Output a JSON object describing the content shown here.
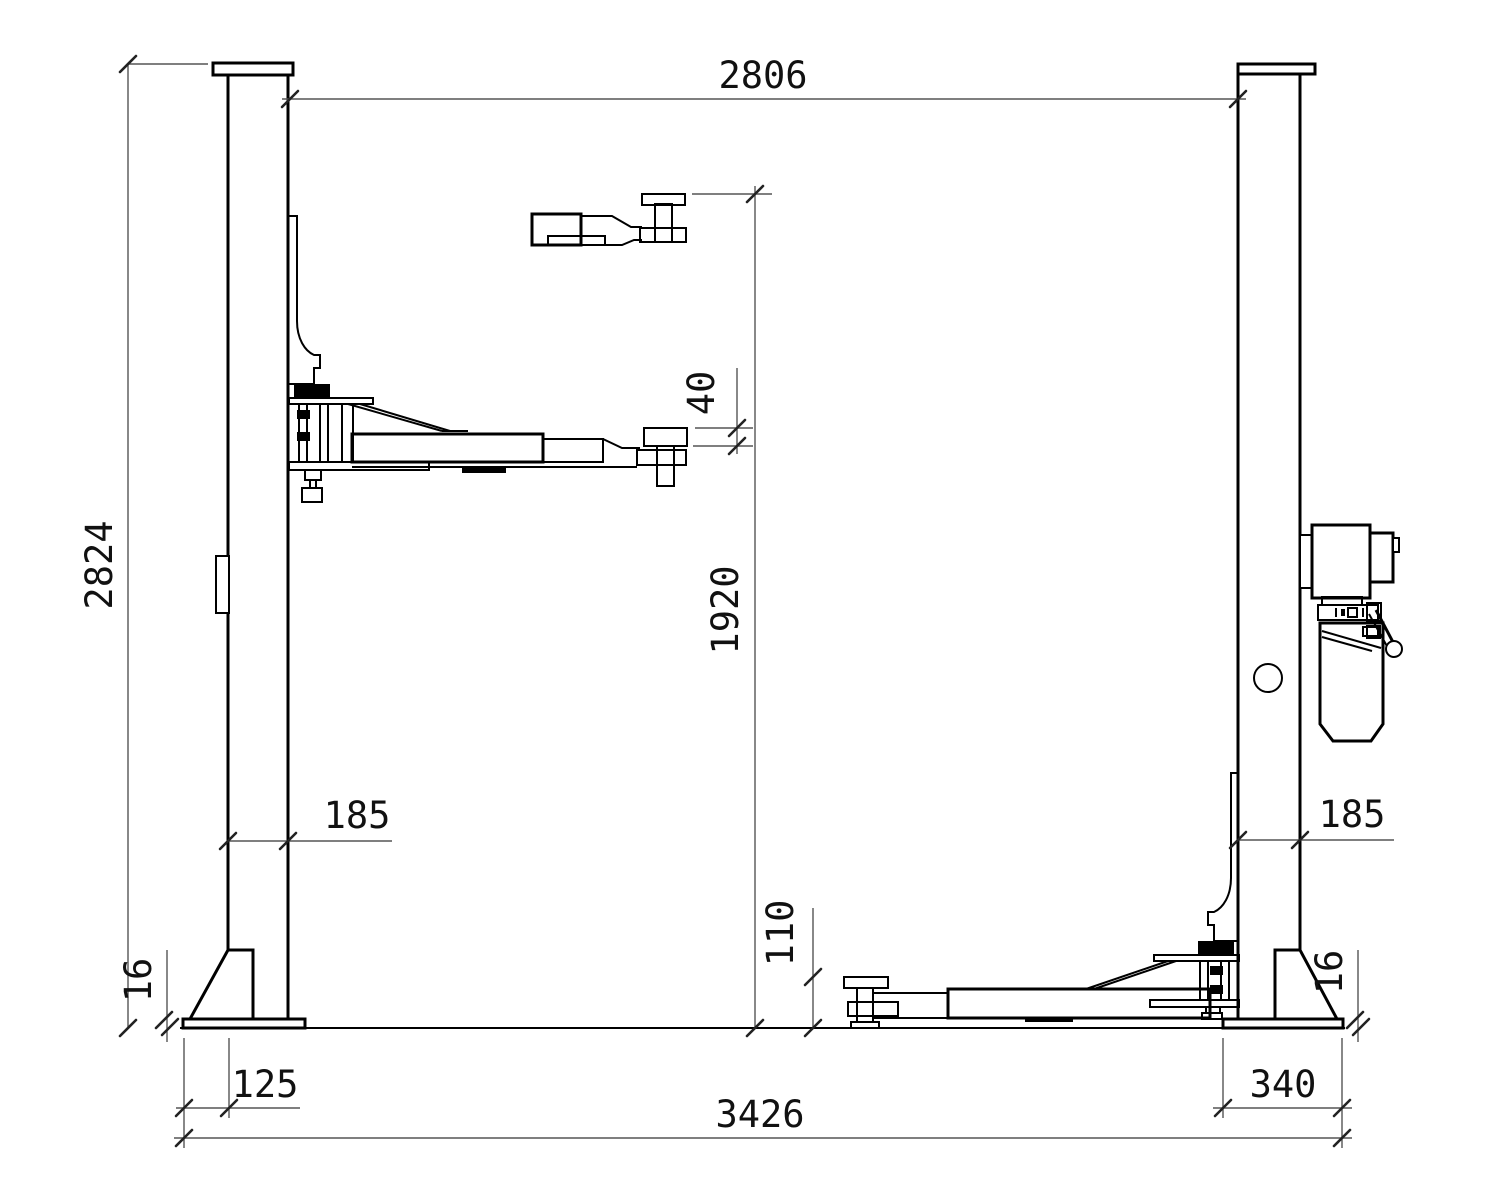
{
  "drawing": {
    "title": "Two-post vehicle lift - dimensional front view",
    "units": "mm",
    "background": "#ffffff",
    "outline_color": "#000000",
    "dimension_line_color": "#555555",
    "text_color": "#111111",
    "dimensions": {
      "overall_height": "2824",
      "between_posts": "2806",
      "max_lift_height": "1920",
      "pad_screw_travel": "40",
      "left_post_width": "185",
      "right_post_width": "185",
      "min_pad_height": "110",
      "left_plate_thickness": "16",
      "right_plate_thickness": "16",
      "left_plate_overhang": "125",
      "right_plate_overhang": "340",
      "overall_width": "3426"
    },
    "parts": {
      "left_post": "left-lift-column",
      "right_post": "right-lift-column",
      "left_arm": "swing-arm-raised",
      "right_arm": "swing-arm-lowered",
      "arm_detail": "arm-pad-at-max-height",
      "power_unit": "hydraulic-power-unit"
    }
  }
}
